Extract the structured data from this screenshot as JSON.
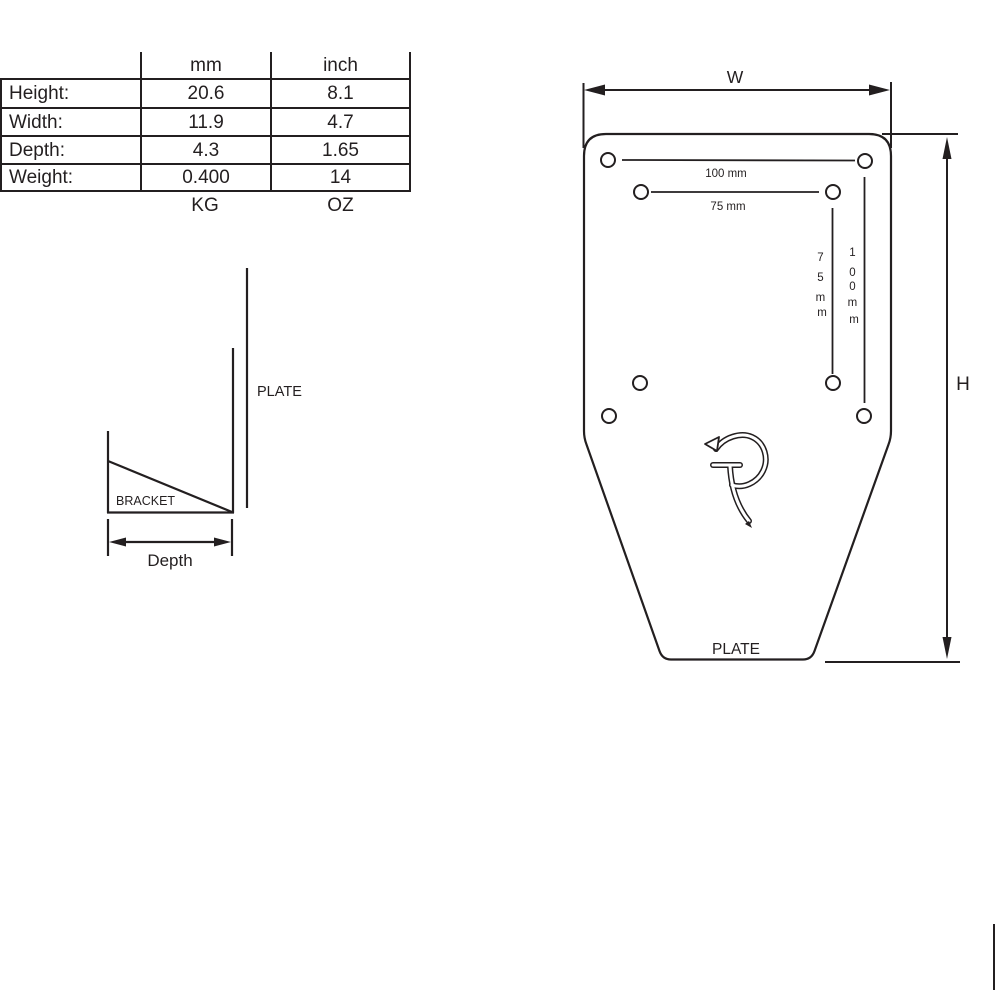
{
  "colors": {
    "line": "#231f20",
    "background": "#ffffff"
  },
  "spec_table": {
    "col_headers": [
      "mm",
      "inch"
    ],
    "rows": [
      {
        "label": "Height:",
        "mm": "20.6",
        "inch": "8.1"
      },
      {
        "label": "Width:",
        "mm": "11.9",
        "inch": "4.7"
      },
      {
        "label": "Depth:",
        "mm": "4.3",
        "inch": "1.65"
      },
      {
        "label": "Weight:",
        "mm": "0.400",
        "inch": "14"
      }
    ],
    "unit_footer": {
      "mm": "KG",
      "inch": "OZ"
    }
  },
  "side_view": {
    "plate_label": "PLATE",
    "bracket_label": "BRACKET",
    "depth_label": "Depth"
  },
  "front_view": {
    "width_label": "W",
    "height_label": "H",
    "plate_label": "PLATE",
    "span_100_label": "100 mm",
    "span_75_label": "75 mm",
    "vert_75_chars": [
      "7",
      "5",
      "m",
      "m"
    ],
    "vert_100_chars": [
      "1",
      "0",
      "0",
      "m",
      "m"
    ]
  }
}
